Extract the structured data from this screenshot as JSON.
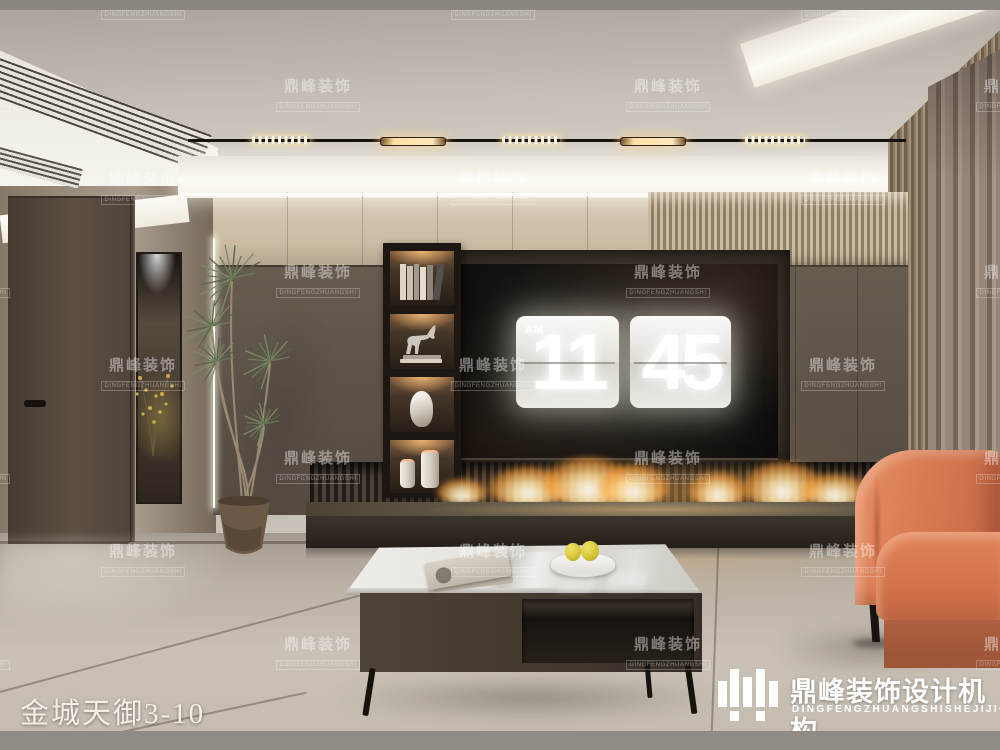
{
  "brand": {
    "watermark_zh": "鼎峰装饰",
    "watermark_en": "DINGFENGZHUANGSHI",
    "logo_zh": "鼎峰装饰设计机构",
    "logo_en": "DINGFENGZHUANGSHISHEJIJIGOU"
  },
  "caption": {
    "project_name": "金城天御3-10"
  },
  "tv_clock": {
    "meridiem": "AM",
    "hour": "11",
    "minute": "45"
  },
  "palette": {
    "ceiling_greige": "#cfc9c0",
    "cove_light": "#fbf8f1",
    "upper_band_beige": "#c9baa2",
    "wood_slats": "#8a7860",
    "dark_wall_panel": "#5d5349",
    "left_wall_taupe": "#9d9184",
    "tv_screen_black": "#0b0908",
    "clock_card": "#e9e7e2",
    "flame_orange": "#ffab4a",
    "sofa_terracotta": "#d67a52",
    "floor_tile": "#bdb5a9",
    "table_marble": "#e9e7e3",
    "table_body_brown": "#463c31",
    "fruit_yellow": "#d9c832"
  }
}
